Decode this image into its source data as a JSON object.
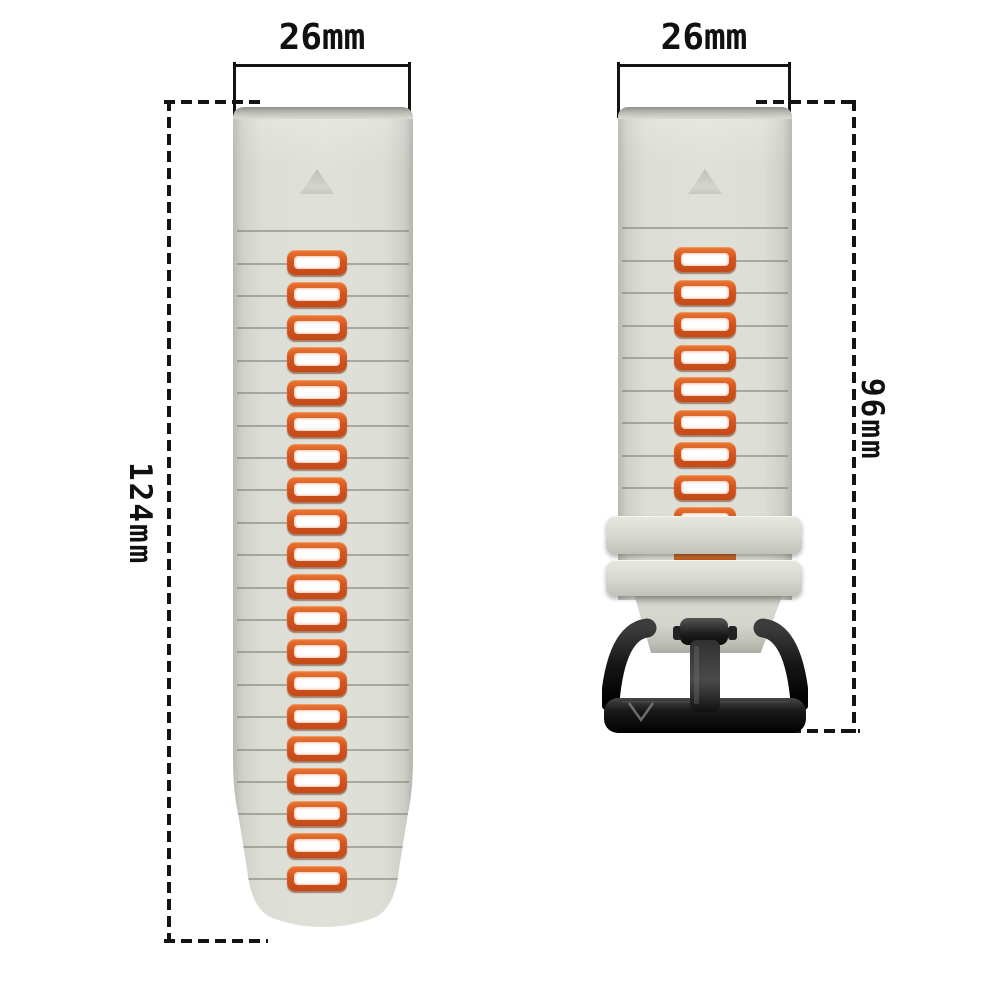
{
  "annotations": {
    "left_band_width": "26mm",
    "right_band_width": "26mm",
    "left_band_length": "124mm",
    "right_band_length": "96mm"
  },
  "bands": {
    "left": {
      "holes": 20,
      "marker": "triangle"
    },
    "right": {
      "holes": 9,
      "marker": "triangle",
      "keepers": 2,
      "buckle": "black pin buckle",
      "buckle_logo": "V"
    }
  },
  "colors": {
    "background": "#ffffff",
    "band": "#dcddd5",
    "band_edge": "#b0b1a9",
    "hole_accent": "#d4541e",
    "hole_inner": "#ffffff",
    "buckle": "#141414",
    "dimension_lines": "#141414"
  }
}
